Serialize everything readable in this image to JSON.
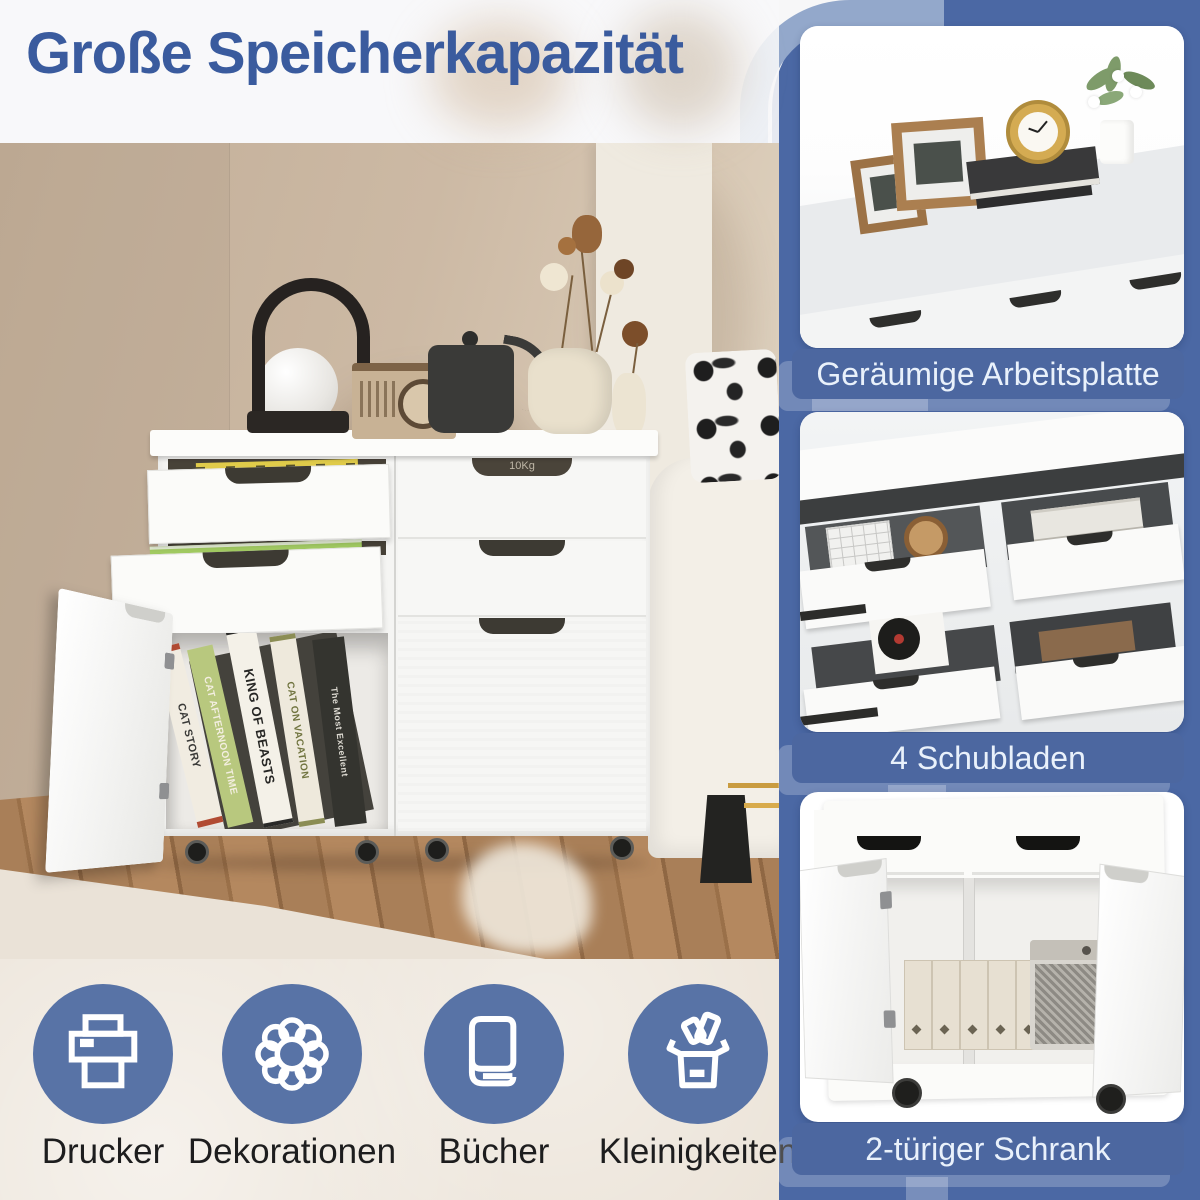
{
  "headline": "Große Speicherkapazität",
  "colors": {
    "headline_blue": "#3a5b9e",
    "band_blue": "#4b68a4",
    "arc_light_blue": "#93a8cb",
    "caption_bar_blue": "#4c67a0",
    "caption_text": "#e9f1fb",
    "icon_circle_blue": "#5873a6",
    "bottom_background": "#ece4d9",
    "label_text": "#1d1d1e"
  },
  "main_photo": {
    "description": "living-room scene with white rolling storage cabinet, two drawers and one door open",
    "drawer_capacity_marking": "10Kg",
    "book_spines": [
      "CAT STORY",
      "CAT AFTERNOON TIME",
      "KING OF BEASTS",
      "CAT ON VACATION",
      "The Most Excellent"
    ]
  },
  "feature_cards": [
    {
      "caption": "Geräumige Arbeitsplatte",
      "image": "cabinet-worktop-with-picture-frames-clock-books-flowers"
    },
    {
      "caption": "4 Schubladen",
      "image": "four-open-drawers-with-calculator-watch-record-player"
    },
    {
      "caption": "2-türiger Schrank",
      "image": "two-door-cabinet-open-with-file-boxes-and-speaker"
    }
  ],
  "storage_icons": [
    {
      "label": "Drucker",
      "icon": "printer-icon"
    },
    {
      "label": "Dekorationen",
      "icon": "flower-icon"
    },
    {
      "label": "Bücher",
      "icon": "book-icon"
    },
    {
      "label": "Kleinigkeiten",
      "icon": "gift-box-icon"
    }
  ]
}
